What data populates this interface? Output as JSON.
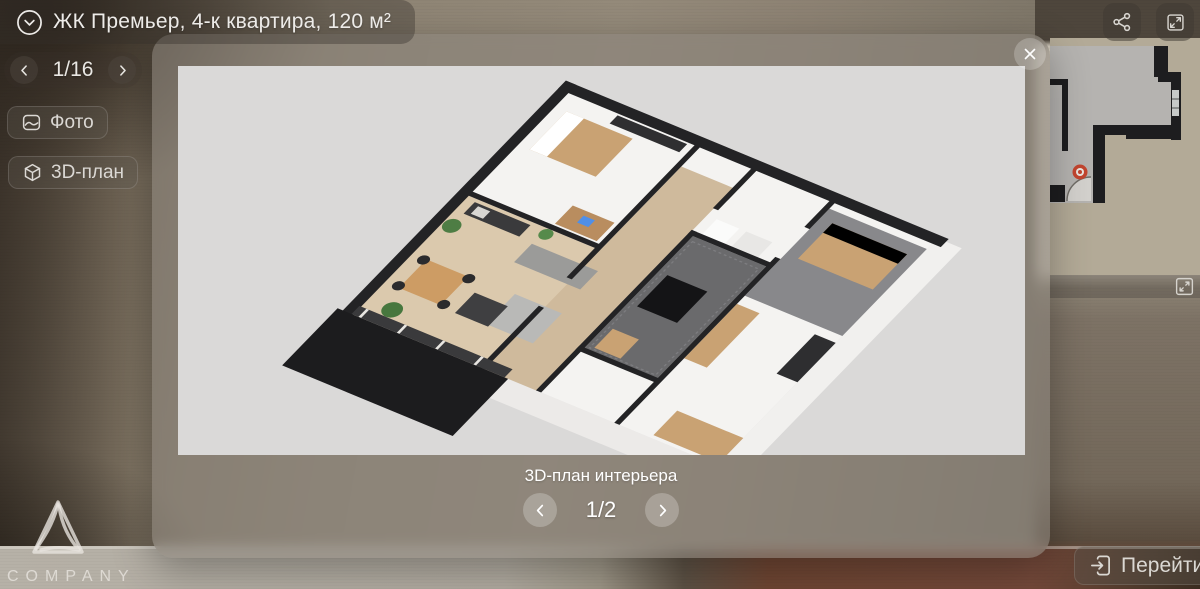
{
  "header": {
    "title": "ЖК Премьер, 4-к квартира, 120 м²",
    "icon": "chevron-down-circle-icon"
  },
  "gallery_nav": {
    "position": "1/16",
    "prev_icon": "chevron-left-icon",
    "next_icon": "chevron-right-icon"
  },
  "view_buttons": {
    "photo_label": "Фото",
    "photo_icon": "photo-icon",
    "plan3d_label": "3D-план",
    "plan3d_icon": "cube-3d-icon"
  },
  "top_actions": {
    "share_icon": "share-icon",
    "fullscreen_icon": "fullscreen-icon"
  },
  "modal": {
    "caption": "3D-план интерьера",
    "pagination": "1/2",
    "close_icon": "close-icon",
    "prev_icon": "chevron-left-icon",
    "next_icon": "chevron-right-icon",
    "content": "3D dollhouse floor plan of a 4-room apartment"
  },
  "minimap": {
    "description": "floor plan with position marker",
    "marker_color": "#c2452f",
    "expand_icon": "expand-icon"
  },
  "goto_button": {
    "label": "Перейти",
    "icon": "enter-icon"
  },
  "logo": {
    "label": "COMPANY"
  },
  "colors": {
    "modal_glass": "rgba(139,132,124,0.58)",
    "canvas_bg": "#dad9d8",
    "wall_black": "#232325",
    "wood_floor": "#dbc9ad",
    "tile_gray": "#6a6a6c",
    "minimap_bg": "#b3aa97"
  }
}
